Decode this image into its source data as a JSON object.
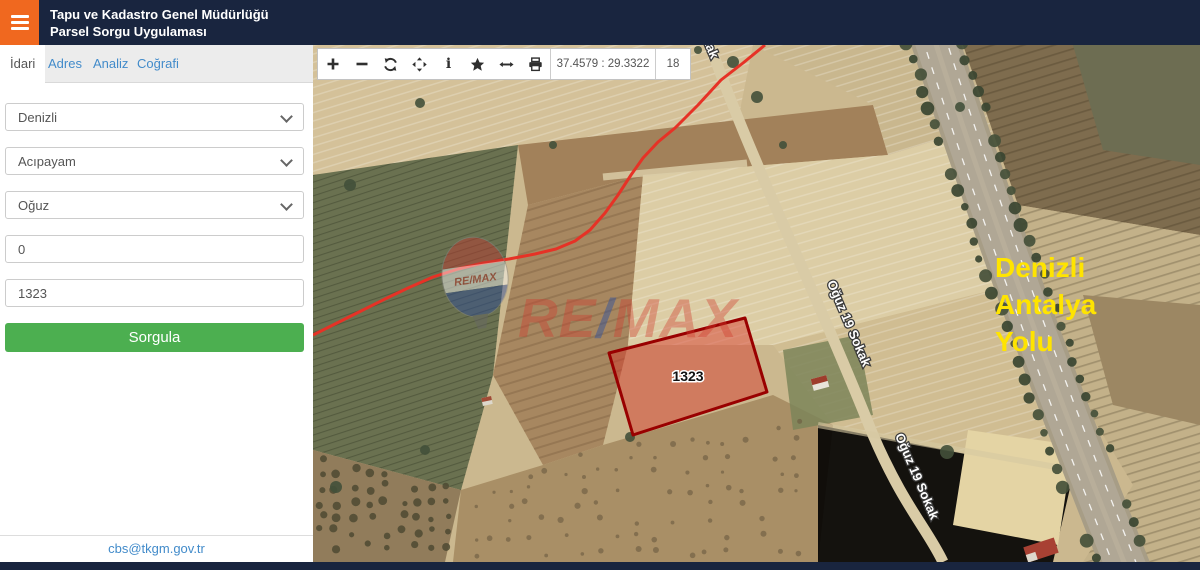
{
  "header": {
    "title_line1": "Tapu ve Kadastro Genel Müdürlüğü",
    "title_line2": "Parsel Sorgu Uygulaması"
  },
  "tabs": {
    "idari": "İdari",
    "adres": "Adres",
    "analiz": "Analiz",
    "cografi": "Coğrafi"
  },
  "form": {
    "province": "Denizli",
    "district": "Acıpayam",
    "neighborhood": "Oğuz",
    "block_value": "0",
    "parcel_value": "1323",
    "query_label": "Sorgula"
  },
  "footer": {
    "contact_email": "cbs@tkgm.gov.tr"
  },
  "map": {
    "toolbar": {
      "coordinates": "37.4579 : 29.3322",
      "zoom_level": "18",
      "icons": [
        "zoom-in",
        "zoom-out",
        "refresh",
        "pan",
        "info",
        "favorites",
        "measure",
        "print"
      ]
    },
    "parcel": {
      "label": "1323"
    },
    "street_label": "Oğuz 19 Sokak",
    "road_label": {
      "line1": "Denizli",
      "line2": "Antalya",
      "line3": "Yolu"
    },
    "watermark": {
      "part1": "RE",
      "slash": "/",
      "part2": "MAX",
      "balloon_text": "RE/MAX"
    },
    "colors": {
      "parcel_stroke": "#990000",
      "parcel_fill": "rgba(214,48,38,0.45)",
      "boundary_line": "#e63226",
      "road_label_color": "#ffe400"
    }
  },
  "colors": {
    "accent_orange": "#f0681f",
    "header_navy": "#19253f",
    "button_green": "#4caf50",
    "link_blue": "#428bca"
  }
}
